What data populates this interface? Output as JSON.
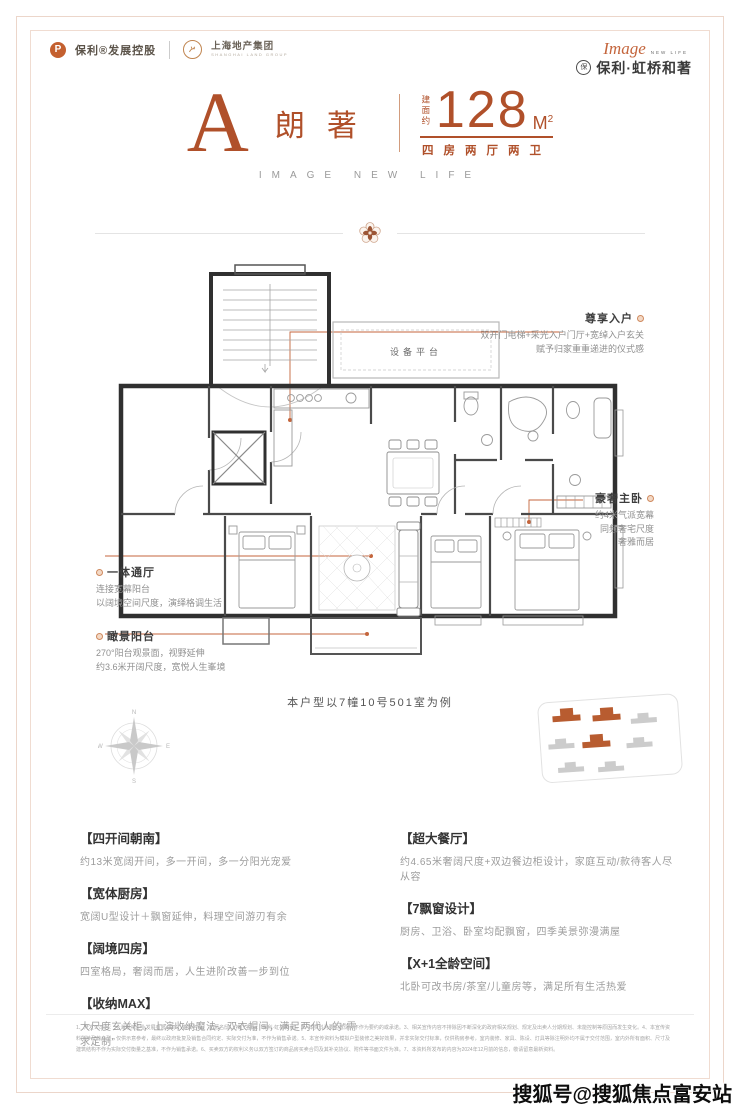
{
  "header": {
    "brand1": "保利®发展控股",
    "brand1_mark": "P",
    "brand2": "上海地产集团",
    "brand2_sub": "SHANGHAI LAND GROUP",
    "logo_script": "Image",
    "logo_sub": "NEW LIFE",
    "seal_glyph": "保",
    "logo_name": "保利·虹桥和著"
  },
  "title": {
    "unit_letter": "A",
    "unit_name": "朗著",
    "area_prefix": "建面约",
    "area_value": "128",
    "area_unit": "M",
    "area_unit_sup": "2",
    "layout": "四房两厅两卫",
    "tagline": "IMAGE NEW LIFE"
  },
  "plan": {
    "platform_label": "设备平台",
    "caption": "本户型以7幢10号501室为例",
    "annotations": {
      "entry": {
        "title": "尊享入户",
        "line1": "双开门电梯+采光入户门厅+宽绰入户玄关",
        "line2": "赋予归家重重递进的仪式感"
      },
      "master": {
        "title": "豪奢主卧",
        "line1": "约4米气派宽幕",
        "line2": "同频奢宅尺度",
        "line3": "奢雅而居"
      },
      "hall": {
        "title": "一体通厅",
        "line1": "连接宽幕阳台",
        "line2": "以阔境空间尺度，演绎格调生活"
      },
      "balcony": {
        "title": "瞰景阳台",
        "line1": "270°阳台观景面，视野延伸",
        "line2": "约3.6米开阔尺度，宽悦人生峯境"
      }
    }
  },
  "compass": {
    "n": "N",
    "s": "S",
    "e": "E",
    "w": "W"
  },
  "features": {
    "left": [
      {
        "title": "【四开间朝南】",
        "body": "约13米宽阔开间，多一开间，多一分阳光宠爱"
      },
      {
        "title": "【宽体厨房】",
        "body": "宽阔U型设计＋飘窗延伸，料理空间游刃有余"
      },
      {
        "title": "【阔境四房】",
        "body": "四室格局，奢阔而居，人生进阶改善一步到位"
      },
      {
        "title": "【收纳MAX】",
        "body": "大尺度玄关柜，上演收纳魔法，双衣帽间，满足两代人的“需求定制”"
      }
    ],
    "right": [
      {
        "title": "【超大餐厅】",
        "body": "约4.65米奢阔尺度+双边餐边柜设计，家庭互动/款待客人尽从容"
      },
      {
        "title": "【7飘窗设计】",
        "body": "厨房、卫浴、卧室均配飘窗，四季美景弥漫满屋"
      },
      {
        "title": "【X+1全龄空间】",
        "body": "北卧可改书房/茶室/儿童房等，满足所有生活热爱"
      }
    ]
  },
  "disclaimer": "1、开发公司为：“上海琨礼企业发展有限公司”，备案名为：“和著名邸”，推广名为：“保利·虹桥和著”。2、本资料为要约邀请，不作为要约的或承诺。3、相关宣传内容不排除因不断深化的政府相关规划、规定及出卖人分期规划、未能控制等原因而发生变化。4、本宣传资料所涉及的户型，仅供示意参考，最终以政府批复及销售合同约定、实际交付为准，不作为销售承诺。5、本宣传资料为模拟户型装修之美好效果，并非实际交付标准，仅供购房参考，室内装修、家具、陈设、灯具等除注明外均不属于交付范围，室内外所有面积、尺寸及建筑结构不作为实际交付衡量之基准，不作为销售承诺。6、买卖双方的权利义务以双方签订的商品房买卖合同及其补充协议、附件等书面文件为准。7、本资料所发布的内容为2024年12月前的信息，敬请留意最新资料。",
  "watermark": "搜狐号@搜狐焦点富安站",
  "colors": {
    "accent": "#b0502a",
    "leader": "#c4653c",
    "frame": "#ecd6ca",
    "wall": "#303030"
  }
}
